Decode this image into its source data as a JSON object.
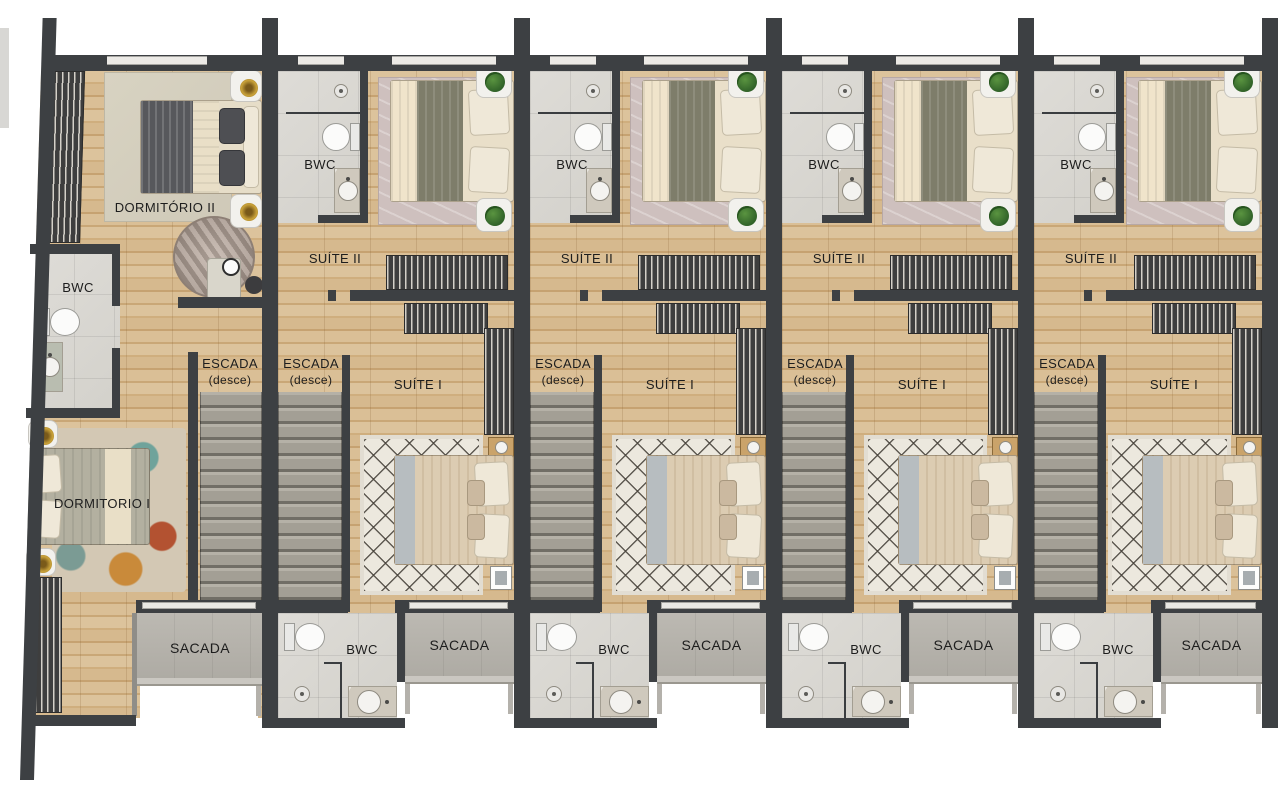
{
  "plan_type": "floor-plan",
  "colors": {
    "wall": "#3d4043",
    "label": "#1d1d1d",
    "window": "#eceae6",
    "wood_light": "#dcc39c",
    "wood_dark": "#c6a271",
    "tile": "#d8d6d1",
    "stair_light": "#b5b1a7",
    "stair_dark": "#716e66",
    "balcony": "#b8b5ae",
    "wardrobe": "#3e3e3e",
    "plant": "#3e7a35",
    "rug_suite2": "#cec0be",
    "rug_diamond": "#ece8de",
    "bed_cream": "#e9dfc9",
    "bed_olive": "#7e7d6a",
    "bed_tan": "#dcccb2"
  },
  "end_unit": {
    "labels": {
      "dormitorio2": "DORMITÓRIO II",
      "bwc": "BWC",
      "dormitorio1": "DORMITORIO I",
      "escada": "ESCADA",
      "escada_note": "(desce)",
      "sacada": "SACADA"
    }
  },
  "typical_unit": {
    "count": 4,
    "labels": {
      "bwc_upper": "BWC",
      "suite2": "SUÍTE II",
      "escada": "ESCADA",
      "escada_note": "(desce)",
      "suite1": "SUÍTE I",
      "bwc_lower": "BWC",
      "sacada": "SACADA"
    }
  }
}
